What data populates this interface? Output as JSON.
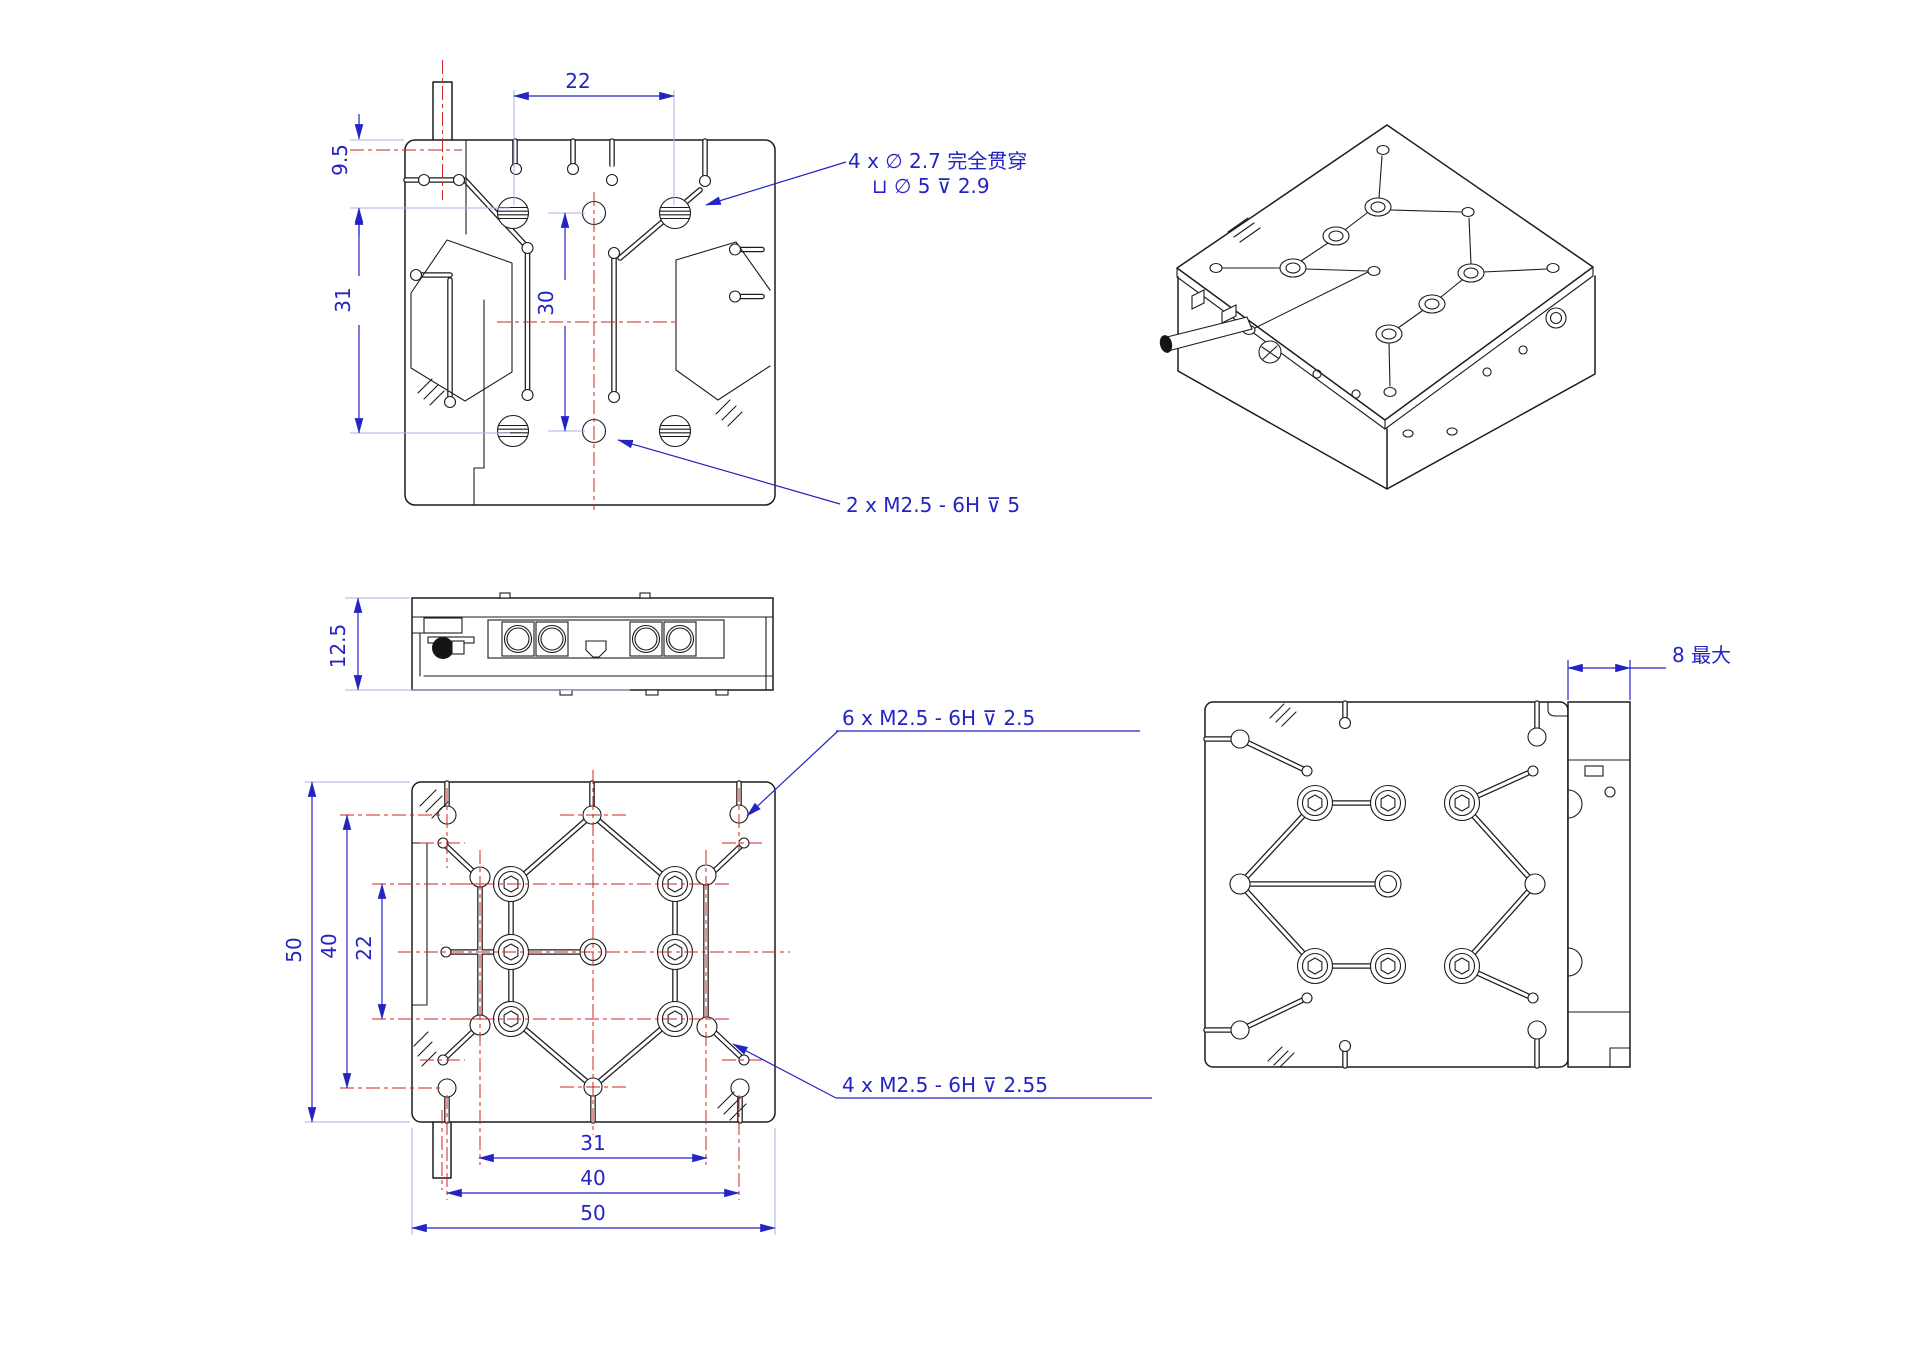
{
  "page": {
    "background": "#ffffff",
    "colors": {
      "linework": "#1c1c1c",
      "dimension_blue": "#2424c4",
      "centerline_red": "#cc2626",
      "extension_light_blue": "#a9b2ea"
    },
    "views": {
      "top_view": {
        "dims": {
          "width": "22",
          "top_offset": "9.5",
          "left_height": "31",
          "center_height": "30"
        },
        "notes": {
          "counterbore_line1": "4 x ∅ 2.7 完全贯穿",
          "counterbore_line2": "⊔ ∅ 5 ⊽ 2.9",
          "tapped_center": "2 x M2.5 - 6H ⊽ 5"
        }
      },
      "side_view": {
        "dims": {
          "height": "12.5"
        }
      },
      "bottom_view": {
        "dims": {
          "outer_height": "50",
          "mid_height": "40",
          "inner_height": "22",
          "inner_width": "31",
          "mid_width": "40",
          "outer_width": "50"
        },
        "notes": {
          "tapped_six": "6 x M2.5 - 6H ⊽ 2.5",
          "tapped_four": "4 x M2.5 - 6H ⊽ 2.55"
        }
      },
      "right_view": {
        "dims": {
          "max_protrusion": "8 最大"
        }
      },
      "iso_view": {}
    }
  }
}
